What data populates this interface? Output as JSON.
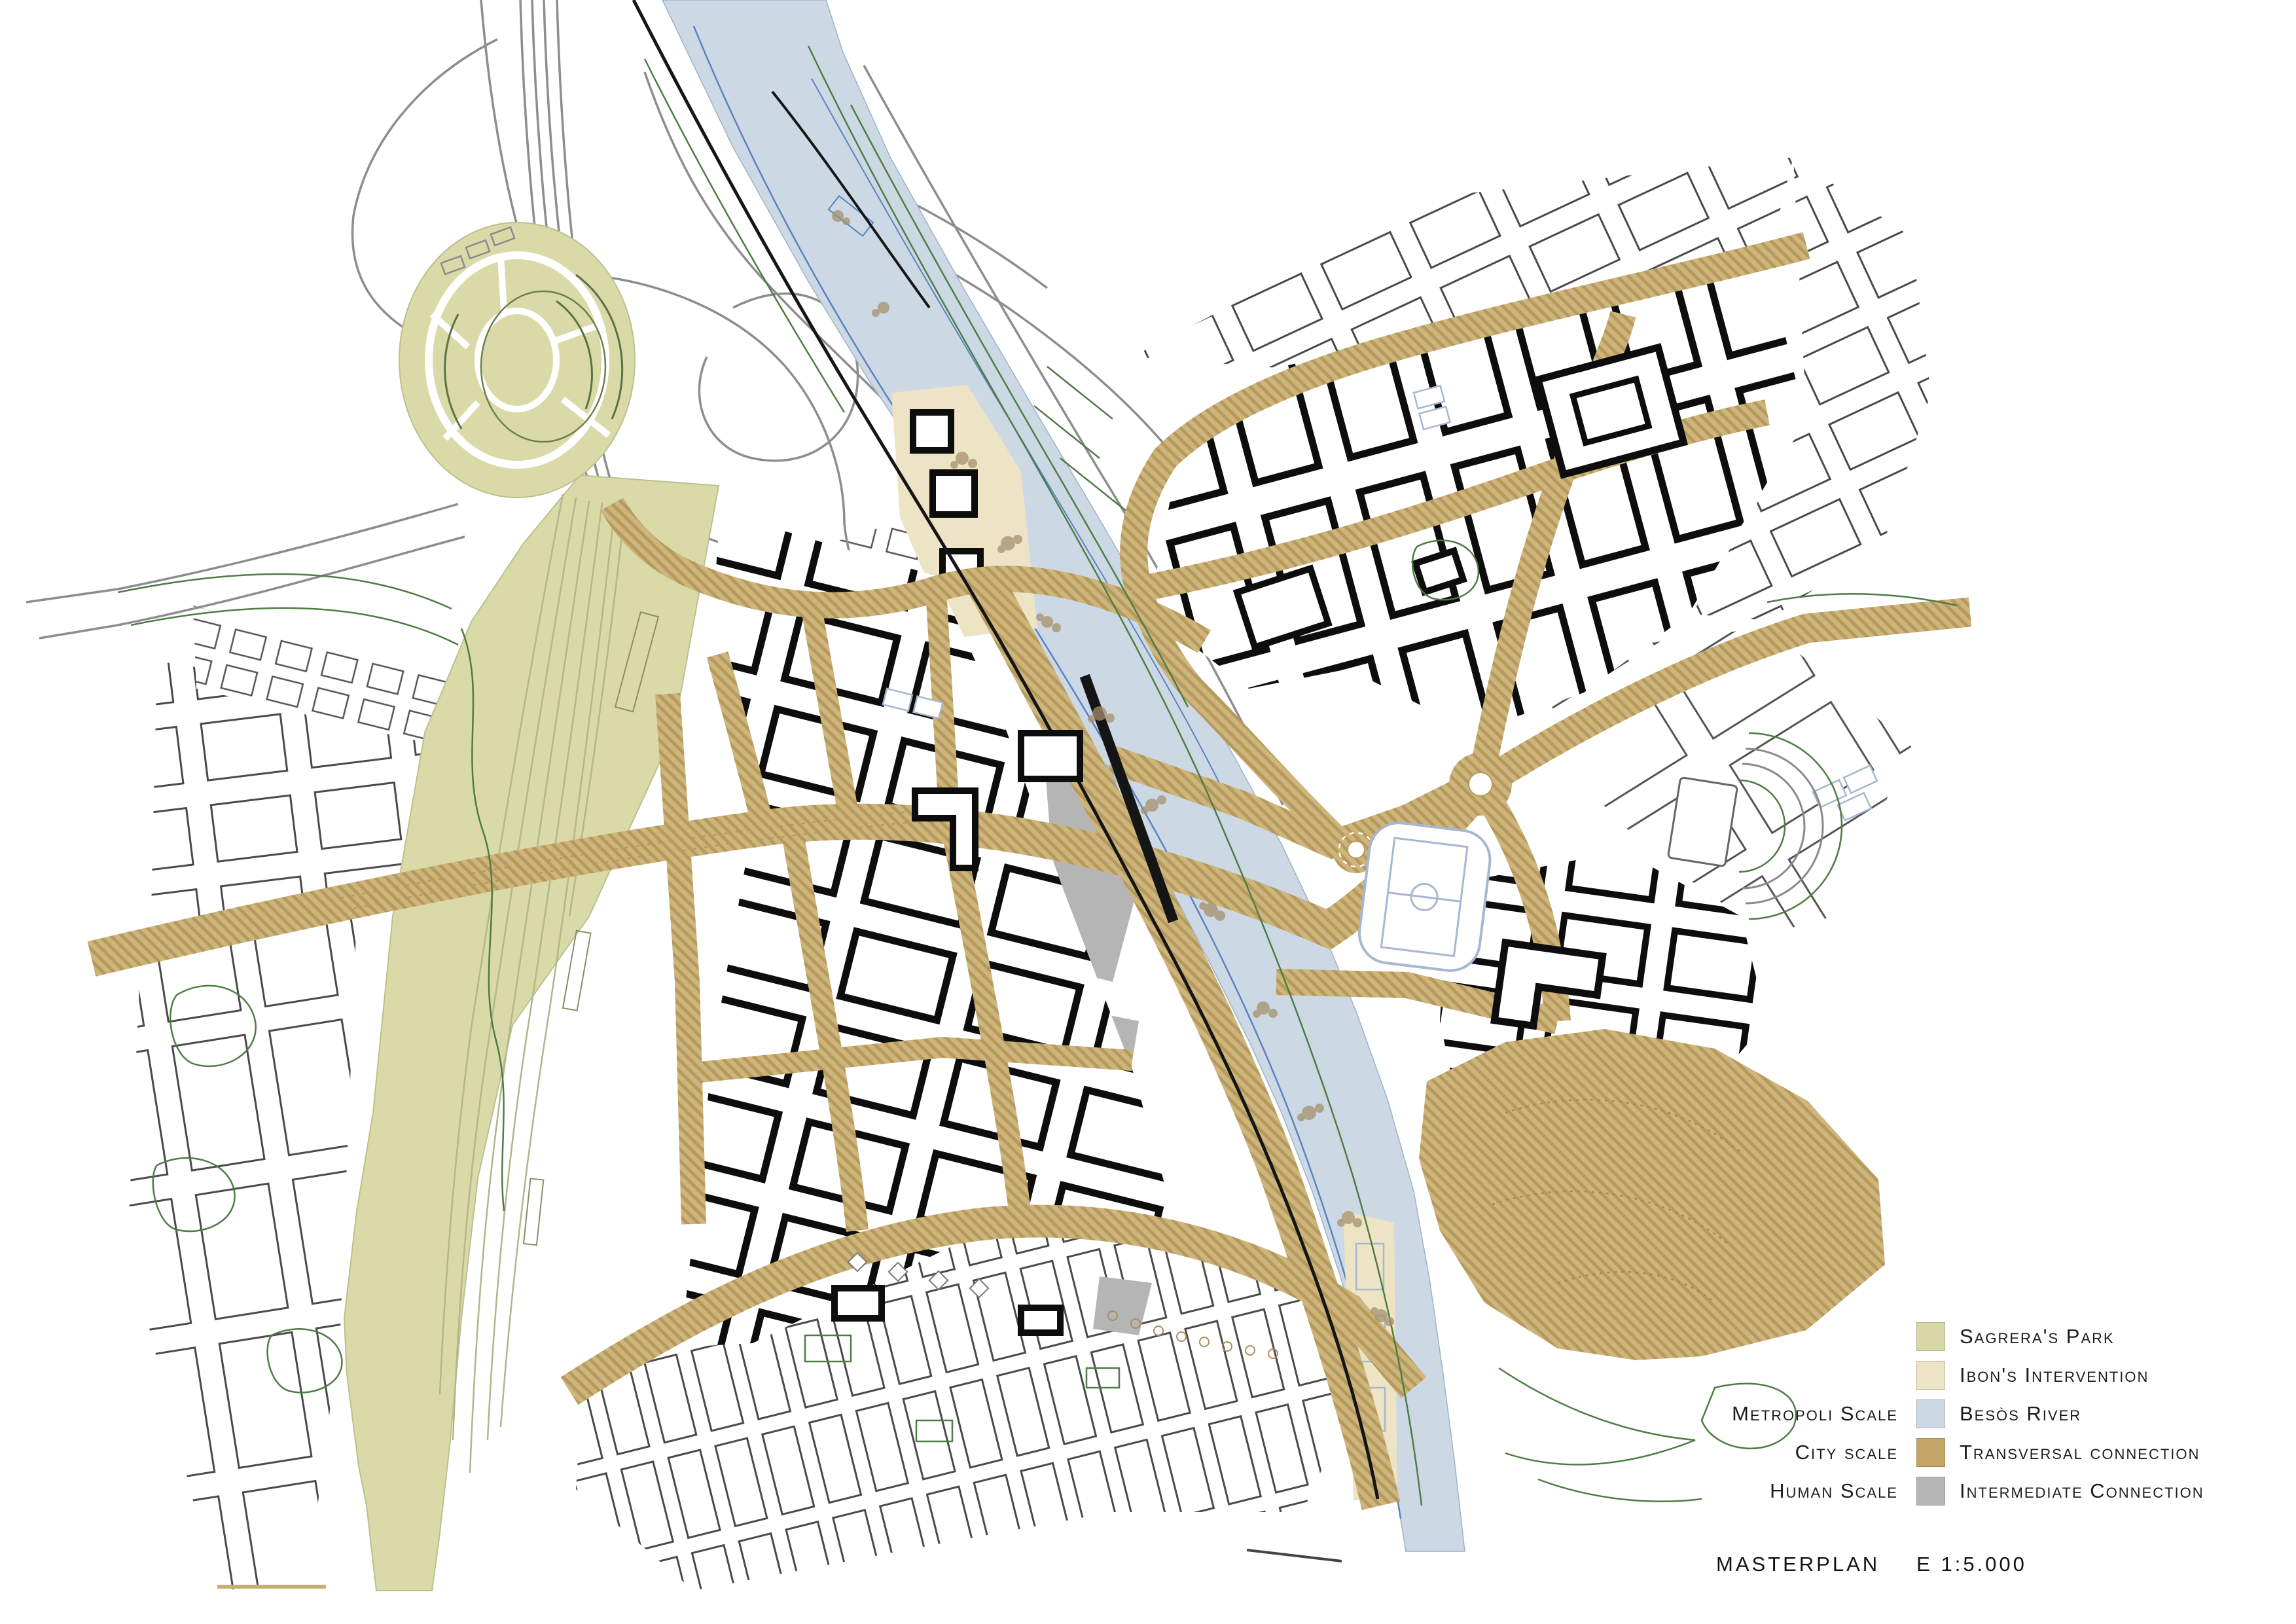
{
  "map_title": {
    "label": "MASTERPLAN",
    "scale": "E 1:5.000"
  },
  "legend": {
    "items": [
      {
        "label": "Sagrera's Park",
        "swatch_color": "#d8d8a6",
        "scale_label": ""
      },
      {
        "label": "Ibon's Intervention",
        "swatch_color": "#ede3c5",
        "scale_label": ""
      },
      {
        "label": "Besòs River",
        "swatch_color": "#ccd9e4",
        "scale_label": "Metropoli Scale"
      },
      {
        "label": "Transversal connection",
        "swatch_color": "#c4a768",
        "scale_label": "City scale"
      },
      {
        "label": "Intermediate Connection",
        "swatch_color": "#b5b5b6",
        "scale_label": "Human Scale"
      }
    ]
  },
  "map": {
    "palette": {
      "park_green": "#dadaa9",
      "park_edge": "#bcc08e",
      "river_blue": "#ccd9e4",
      "river_line": "#5a82c0",
      "road_tan": "#cdb57c",
      "road_hatch": "#b6995c",
      "intervention_cream": "#ede3c5",
      "connection_gray": "#b5b5b6",
      "building_black": "#0d0d0d",
      "fabric_line": "#4a4a4a",
      "vegetation_green": "#4e7c44",
      "highway_gray": "#8d8d8d",
      "rail_black": "#151515",
      "tree_brown": "#a5906c",
      "court_blue": "#a8b6d0",
      "contour_tan": "#a8874f"
    }
  }
}
